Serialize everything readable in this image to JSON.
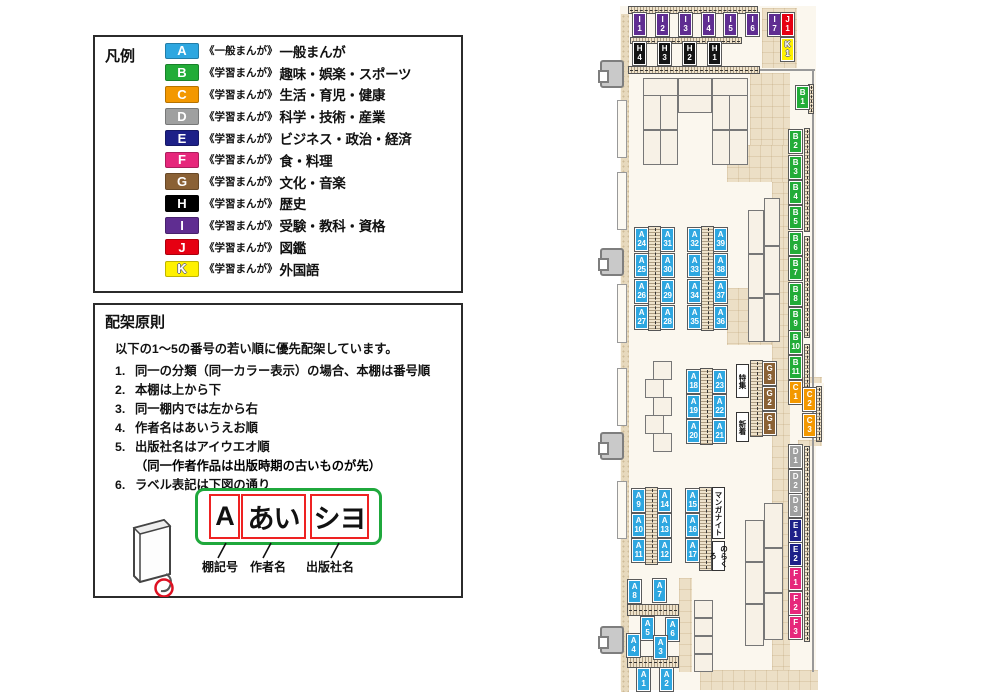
{
  "legend": {
    "title": "凡例",
    "items": [
      {
        "code": "A",
        "color": "#2ea7e0",
        "scope": "《一般まんが》",
        "category": "一般まんが"
      },
      {
        "code": "B",
        "color": "#22ac38",
        "scope": "《学習まんが》",
        "category": "趣味・娯楽・スポーツ"
      },
      {
        "code": "C",
        "color": "#f39800",
        "scope": "《学習まんが》",
        "category": "生活・育児・健康"
      },
      {
        "code": "D",
        "color": "#9fa0a0",
        "scope": "《学習まんが》",
        "category": "科学・技術・産業"
      },
      {
        "code": "E",
        "color": "#1d2088",
        "scope": "《学習まんが》",
        "category": "ビジネス・政治・経済"
      },
      {
        "code": "F",
        "color": "#e6277b",
        "scope": "《学習まんが》",
        "category": "食・料理"
      },
      {
        "code": "G",
        "color": "#8a6135",
        "scope": "《学習まんが》",
        "category": "文化・音楽"
      },
      {
        "code": "H",
        "color": "#000000",
        "scope": "《学習まんが》",
        "category": "歴史"
      },
      {
        "code": "I",
        "color": "#5f2d91",
        "scope": "《学習まんが》",
        "category": "受験・教科・資格"
      },
      {
        "code": "J",
        "color": "#e60012",
        "scope": "《学習まんが》",
        "category": "図鑑"
      },
      {
        "code": "K",
        "color": "#fff100",
        "scope": "《学習まんが》",
        "category": "外国語"
      }
    ]
  },
  "principles": {
    "title": "配架原則",
    "intro": "以下の1〜5の番号の若い順に優先配架しています。",
    "rules": [
      {
        "num": "1.",
        "text": "同一の分類（同一カラー表示）の場合、本棚は番号順"
      },
      {
        "num": "2.",
        "text": "本棚は上から下"
      },
      {
        "num": "3.",
        "text": "同一棚内では左から右"
      },
      {
        "num": "4.",
        "text": "作者名はあいうえお順"
      },
      {
        "num": "5.",
        "text": "出版社名はアイウエオ順",
        "sub": "（同一作者作品は出版時期の古いものが先）"
      },
      {
        "num": "6.",
        "text": "ラベル表記は下図の通り"
      }
    ],
    "label_example": {
      "shelf_code": "A",
      "author": "あい",
      "publisher": "シヨ",
      "captions": [
        "棚記号",
        "作者名",
        "出版社名"
      ]
    }
  },
  "map": {
    "shelf_labels": [
      {
        "t": "I1",
        "x": 633,
        "y": 13
      },
      {
        "t": "I2",
        "x": 656,
        "y": 13
      },
      {
        "t": "I3",
        "x": 679,
        "y": 13
      },
      {
        "t": "I4",
        "x": 702,
        "y": 13
      },
      {
        "t": "I5",
        "x": 724,
        "y": 13
      },
      {
        "t": "I6",
        "x": 746,
        "y": 13
      },
      {
        "t": "I7",
        "x": 768,
        "y": 13
      },
      {
        "t": "J1",
        "x": 781,
        "y": 13
      },
      {
        "t": "K1",
        "x": 781,
        "y": 38
      },
      {
        "t": "H4",
        "x": 633,
        "y": 42
      },
      {
        "t": "H3",
        "x": 658,
        "y": 42
      },
      {
        "t": "H2",
        "x": 683,
        "y": 42
      },
      {
        "t": "H1",
        "x": 708,
        "y": 42
      },
      {
        "t": "B1",
        "x": 796,
        "y": 86
      },
      {
        "t": "B2",
        "x": 789,
        "y": 130
      },
      {
        "t": "B3",
        "x": 789,
        "y": 156
      },
      {
        "t": "B4",
        "x": 789,
        "y": 181
      },
      {
        "t": "B5",
        "x": 789,
        "y": 206
      },
      {
        "t": "B6",
        "x": 789,
        "y": 232
      },
      {
        "t": "B7",
        "x": 789,
        "y": 257
      },
      {
        "t": "B8",
        "x": 789,
        "y": 283
      },
      {
        "t": "B9",
        "x": 789,
        "y": 308
      },
      {
        "t": "B10",
        "x": 789,
        "y": 331
      },
      {
        "t": "B11",
        "x": 789,
        "y": 356
      },
      {
        "t": "C1",
        "x": 789,
        "y": 381
      },
      {
        "t": "C2",
        "x": 803,
        "y": 388
      },
      {
        "t": "C3",
        "x": 803,
        "y": 414
      },
      {
        "t": "D1",
        "x": 789,
        "y": 445
      },
      {
        "t": "D2",
        "x": 789,
        "y": 470
      },
      {
        "t": "D3",
        "x": 789,
        "y": 494
      },
      {
        "t": "E1",
        "x": 789,
        "y": 519
      },
      {
        "t": "E2",
        "x": 789,
        "y": 543
      },
      {
        "t": "F1",
        "x": 789,
        "y": 567
      },
      {
        "t": "F2",
        "x": 789,
        "y": 592
      },
      {
        "t": "F3",
        "x": 789,
        "y": 616
      },
      {
        "t": "G3",
        "x": 763,
        "y": 362
      },
      {
        "t": "G2",
        "x": 763,
        "y": 387
      },
      {
        "t": "G1",
        "x": 763,
        "y": 412
      },
      {
        "t": "A24",
        "x": 635,
        "y": 228
      },
      {
        "t": "A25",
        "x": 635,
        "y": 254
      },
      {
        "t": "A26",
        "x": 635,
        "y": 280
      },
      {
        "t": "A27",
        "x": 635,
        "y": 306
      },
      {
        "t": "A31",
        "x": 661,
        "y": 228
      },
      {
        "t": "A30",
        "x": 661,
        "y": 254
      },
      {
        "t": "A29",
        "x": 661,
        "y": 280
      },
      {
        "t": "A28",
        "x": 661,
        "y": 306
      },
      {
        "t": "A32",
        "x": 688,
        "y": 228
      },
      {
        "t": "A33",
        "x": 688,
        "y": 254
      },
      {
        "t": "A34",
        "x": 688,
        "y": 280
      },
      {
        "t": "A35",
        "x": 688,
        "y": 306
      },
      {
        "t": "A39",
        "x": 714,
        "y": 228
      },
      {
        "t": "A38",
        "x": 714,
        "y": 254
      },
      {
        "t": "A37",
        "x": 714,
        "y": 280
      },
      {
        "t": "A36",
        "x": 714,
        "y": 306
      },
      {
        "t": "A18",
        "x": 687,
        "y": 370
      },
      {
        "t": "A19",
        "x": 687,
        "y": 395
      },
      {
        "t": "A20",
        "x": 687,
        "y": 420
      },
      {
        "t": "A23",
        "x": 713,
        "y": 370
      },
      {
        "t": "A22",
        "x": 713,
        "y": 395
      },
      {
        "t": "A21",
        "x": 713,
        "y": 420
      },
      {
        "t": "A9",
        "x": 632,
        "y": 489
      },
      {
        "t": "A10",
        "x": 632,
        "y": 514
      },
      {
        "t": "A11",
        "x": 632,
        "y": 539
      },
      {
        "t": "A14",
        "x": 658,
        "y": 489
      },
      {
        "t": "A13",
        "x": 658,
        "y": 514
      },
      {
        "t": "A12",
        "x": 658,
        "y": 539
      },
      {
        "t": "A15",
        "x": 686,
        "y": 489
      },
      {
        "t": "A16",
        "x": 686,
        "y": 514
      },
      {
        "t": "A17",
        "x": 686,
        "y": 539
      },
      {
        "t": "A8",
        "x": 628,
        "y": 580
      },
      {
        "t": "A7",
        "x": 653,
        "y": 579
      },
      {
        "t": "A5",
        "x": 641,
        "y": 617
      },
      {
        "t": "A6",
        "x": 666,
        "y": 618
      },
      {
        "t": "A4",
        "x": 627,
        "y": 634
      },
      {
        "t": "A3",
        "x": 654,
        "y": 636
      },
      {
        "t": "A1",
        "x": 637,
        "y": 668
      },
      {
        "t": "A2",
        "x": 660,
        "y": 668
      }
    ],
    "note_labels": [
      {
        "t": "特集",
        "x": 736,
        "y": 364,
        "h": 34
      },
      {
        "t": "新着",
        "x": 736,
        "y": 412,
        "h": 30
      },
      {
        "t": "マンガナイト",
        "x": 712,
        "y": 487,
        "h": 52
      },
      {
        "t": "のらくろ",
        "x": 712,
        "y": 541,
        "h": 30
      }
    ]
  }
}
